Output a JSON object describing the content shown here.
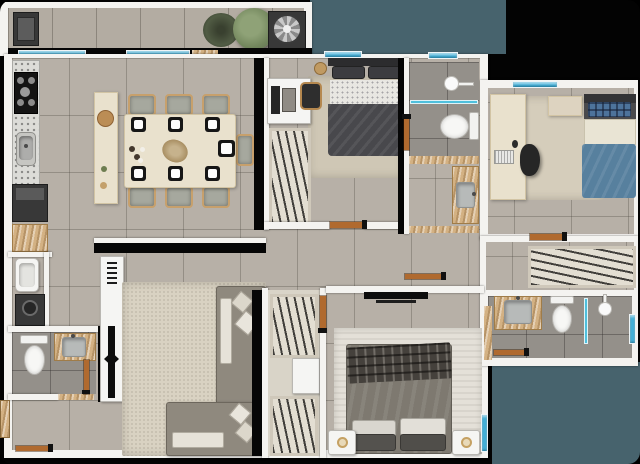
{
  "meta": {
    "title": "Apartment floor plan - furnished top-down 3D render",
    "type": "floor-plan",
    "canvas": {
      "width": 640,
      "height": 464
    },
    "visible_text": "none"
  },
  "palette": {
    "frame": "#030303",
    "outdoor": "#47636d",
    "wall": "#f4f3f0",
    "floor_tile": "#b7b0a7",
    "bath_tile": "#94908a",
    "rug_beige": "#d9d2c2",
    "rug_light": "#e4e0d8",
    "wood_door": "#b06a2f",
    "window_glass": "#41b1d9",
    "granite": "#dcdcd8",
    "travertine": "#d3b183",
    "island_cream": "#e9e1cd",
    "sofa_gray": "#8f897e",
    "bed_dark": "#48484c",
    "bed_blue": "#57809e",
    "bed_master": "#7e7970",
    "closet_base": "#e3ded2",
    "appliance_dark": "#383838",
    "plant_green": "#74885e"
  },
  "rooms": [
    {
      "id": "balcony",
      "label": "balcony-terrace",
      "items": [
        "barbecue-grill",
        "potted-succulent",
        "green-shrub",
        "ac-fan-unit",
        "two-windows-to-kitchen"
      ]
    },
    {
      "id": "kitchen-dining",
      "label": "kitchen-and-dining",
      "items": [
        "granite-counter",
        "gas-cooktop-5-burners",
        "kitchen-sink",
        "cream-island",
        "dining-table",
        "7-chairs",
        "7-black-plates",
        "centerpiece"
      ]
    },
    {
      "id": "service",
      "label": "service-area",
      "items": [
        "refrigerator",
        "tall-cabinet",
        "laundry-sink",
        "washing-machine"
      ]
    },
    {
      "id": "bathroom-social",
      "label": "social-bathroom",
      "items": [
        "toilet",
        "vanity-with-sink",
        "wood-door"
      ]
    },
    {
      "id": "living",
      "label": "living-room",
      "items": [
        "tv-console",
        "tv",
        "l-shaped-sofa",
        "area-rug",
        "throw-pillows",
        "entry-door"
      ]
    },
    {
      "id": "bedroom-1",
      "label": "bedroom-top-middle",
      "items": [
        "single-bed-dark-duvet",
        "desk",
        "desk-chair",
        "wardrobe-hanging-clothes",
        "rug",
        "window"
      ]
    },
    {
      "id": "bathroom-middle",
      "label": "shower-bathroom",
      "items": [
        "shower-head",
        "glass-partition",
        "toilet",
        "window",
        "wood-door"
      ]
    },
    {
      "id": "vanity-room",
      "label": "vanity-lavabo",
      "items": [
        "stone-counter",
        "gray-sink"
      ]
    },
    {
      "id": "bedroom-2",
      "label": "bedroom-top-right",
      "items": [
        "single-bed-blue-duvet",
        "plaid-pillow",
        "corner-desk",
        "keyboard",
        "office-chair",
        "nightstand",
        "rug",
        "window",
        "wood-door"
      ]
    },
    {
      "id": "hall-closet",
      "label": "hall-wardrobe",
      "items": [
        "hanging-rail"
      ]
    },
    {
      "id": "master-bathroom",
      "label": "master-ensuite",
      "items": [
        "vanity-with-sink",
        "toilet",
        "shower-head",
        "glass-partition",
        "window",
        "wood-door"
      ]
    },
    {
      "id": "walk-in-closet",
      "label": "walk-in-closet",
      "items": [
        "hanging-section-top",
        "shelf-unit",
        "hanging-section-bottom",
        "wood-door"
      ]
    },
    {
      "id": "master-bedroom",
      "label": "master-bedroom",
      "items": [
        "double-bed",
        "plaid-throw",
        "pillows",
        "nightstand-left-with-lamp",
        "nightstand-right-with-lamp",
        "wall-tv",
        "rug",
        "window"
      ]
    }
  ],
  "counts": {
    "windows": 8,
    "wood_doors": 8,
    "toilets": 4,
    "sinks": 6,
    "beds": 3,
    "showers": 2
  }
}
